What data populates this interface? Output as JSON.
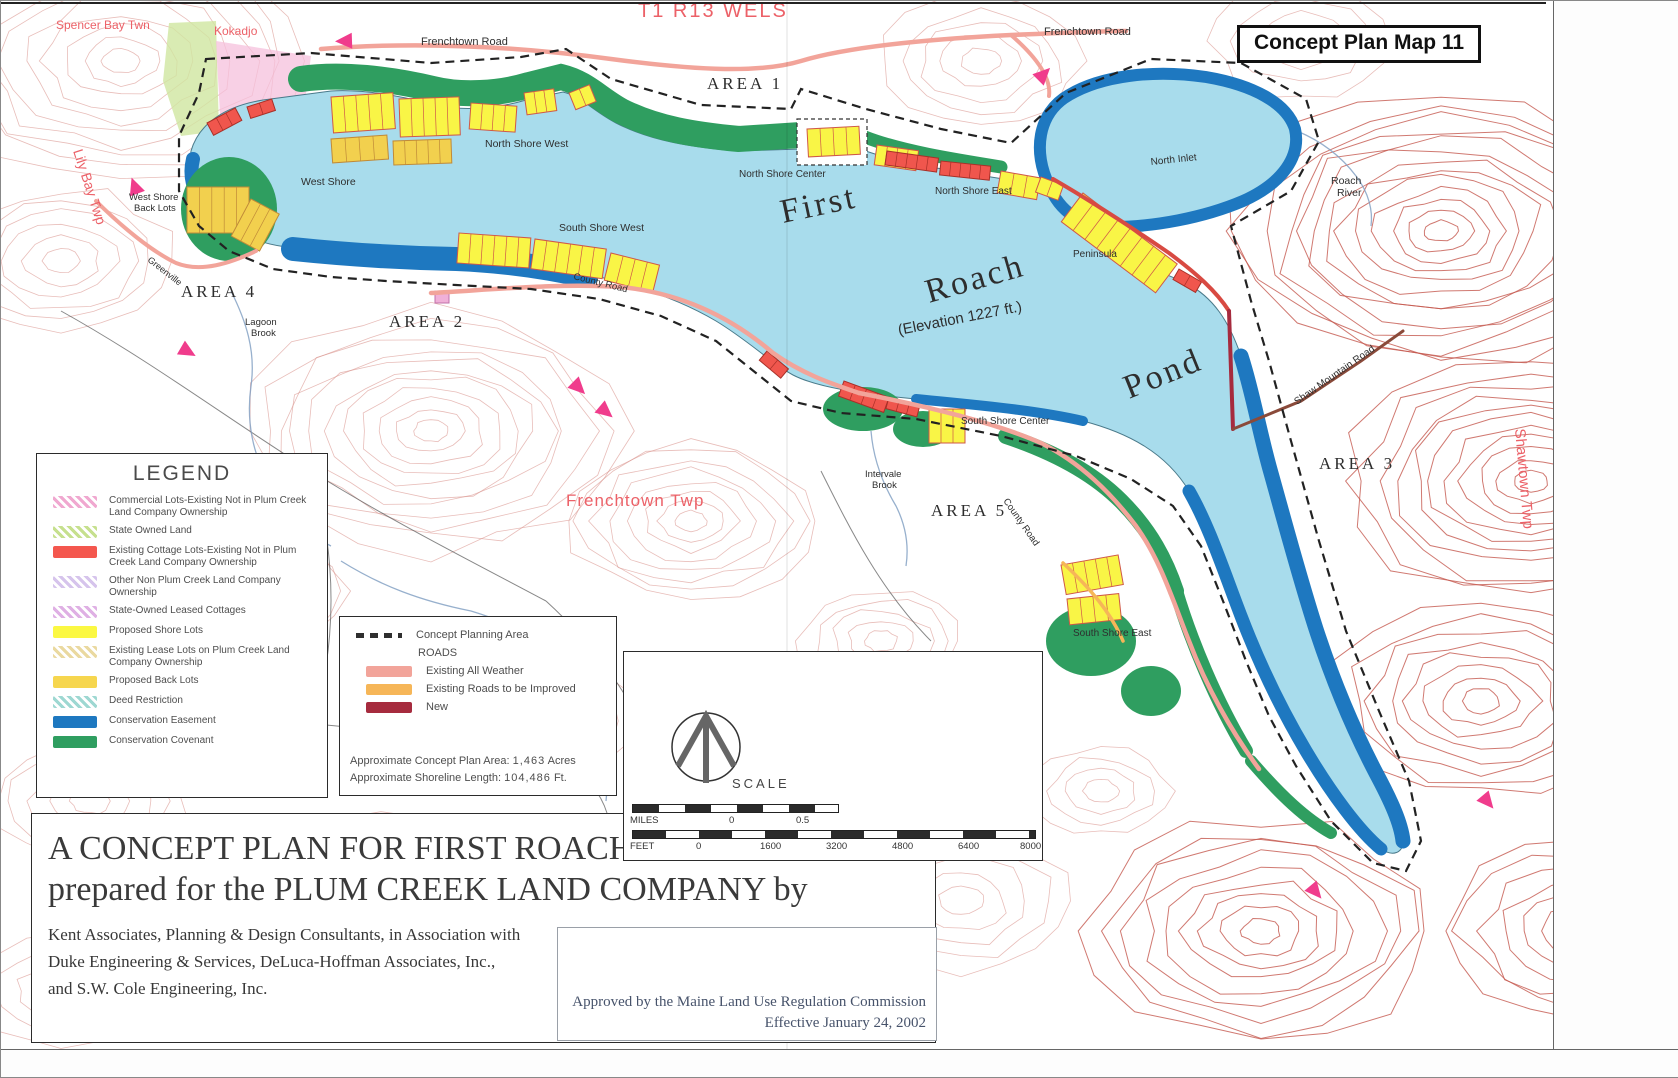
{
  "page": {
    "map_title": "Concept Plan Map 11"
  },
  "legend": {
    "title": "LEGEND",
    "items": [
      {
        "label": "Commercial Lots-Existing Not in Plum Creek Land Company Ownership",
        "color": "#f0a8d0",
        "style": "hatch"
      },
      {
        "label": "State Owned Land",
        "color": "#c6e08e",
        "style": "hatch"
      },
      {
        "label": "Existing Cottage Lots-Existing Not in Plum Creek Land Company Ownership",
        "color": "#f4574e",
        "style": "solid"
      },
      {
        "label": "Other Non Plum Creek Land Company Ownership",
        "color": "#d6c4ec",
        "style": "hatch"
      },
      {
        "label": "State-Owned Leased Cottages",
        "color": "#dfb0e4",
        "style": "hatch"
      },
      {
        "label": "Proposed Shore Lots",
        "color": "#fbf842",
        "style": "solid"
      },
      {
        "label": "Existing Lease Lots on Plum Creek Land Company Ownership",
        "color": "#ead9a0",
        "style": "hatch"
      },
      {
        "label": "Proposed Back Lots",
        "color": "#f6d64e",
        "style": "solid"
      },
      {
        "label": "Deed Restriction",
        "color": "#9ed8d2",
        "style": "hatch"
      },
      {
        "label": "Conservation Easement",
        "color": "#1e78c0",
        "style": "solid"
      },
      {
        "label": "Conservation Covenant",
        "color": "#2f9e60",
        "style": "solid"
      }
    ]
  },
  "plan_legend": {
    "planning_area": "Concept Planning Area",
    "roads_title": "ROADS",
    "roads": [
      {
        "label": "Existing All Weather",
        "color": "#f2a49a"
      },
      {
        "label": "Existing Roads to be Improved",
        "color": "#f6b658"
      },
      {
        "label": "New",
        "color": "#a62b3e"
      }
    ],
    "area_label": "Approximate Concept Plan Area:",
    "area_value": "1,463",
    "area_unit": "Acres",
    "shoreline_label": "Approximate Shoreline Length:",
    "shoreline_value": "104,486",
    "shoreline_unit": "Ft."
  },
  "scale": {
    "title": "SCALE",
    "miles": {
      "label": "MILES",
      "ticks": [
        "0",
        "0.5"
      ]
    },
    "feet": {
      "label": "FEET",
      "ticks": [
        "0",
        "1600",
        "3200",
        "4800",
        "6400",
        "8000"
      ]
    }
  },
  "title_block": {
    "line1": "A CONCEPT PLAN FOR FIRST ROACH POND",
    "line2": "prepared for the PLUM CREEK LAND COMPANY by",
    "credits": [
      "Kent Associates, Planning & Design Consultants, in Association with",
      "Duke Engineering & Services, DeLuca-Hoffman Associates, Inc.,",
      "and S.W. Cole Engineering, Inc."
    ],
    "approval": [
      "Approved by the Maine Land Use Regulation Commission",
      "Effective January 24, 2002"
    ]
  },
  "map_labels": [
    {
      "t": "Spencer Bay Twn",
      "x": 55,
      "y": 28,
      "s": 12,
      "c": "r"
    },
    {
      "t": "Kokadjo",
      "x": 213,
      "y": 34,
      "s": 12,
      "c": "r"
    },
    {
      "t": "T1 R13 WELS",
      "x": 637,
      "y": 16,
      "s": 20,
      "c": "r",
      "ls": 2
    },
    {
      "t": "Frenchtown Road",
      "x": 420,
      "y": 44,
      "s": 11,
      "c": "k"
    },
    {
      "t": "Frenchtown Road",
      "x": 1043,
      "y": 34,
      "s": 11,
      "c": "k"
    },
    {
      "t": "AREA 1",
      "x": 706,
      "y": 88,
      "s": 17,
      "c": "k",
      "f": "serif",
      "ls": 3
    },
    {
      "t": "Lily Bay Twp",
      "x": 72,
      "y": 150,
      "s": 14,
      "c": "r",
      "rot": 72
    },
    {
      "t": "West Shore",
      "x": 128,
      "y": 199,
      "s": 9.5,
      "c": "k"
    },
    {
      "t": "Back Lots",
      "x": 133,
      "y": 210,
      "s": 9.5,
      "c": "k"
    },
    {
      "t": "West Shore",
      "x": 300,
      "y": 184,
      "s": 10.5,
      "c": "k"
    },
    {
      "t": "North Shore West",
      "x": 484,
      "y": 146,
      "s": 10.5,
      "c": "k"
    },
    {
      "t": "North Shore Center",
      "x": 738,
      "y": 176,
      "s": 10,
      "c": "k"
    },
    {
      "t": "North Shore East",
      "x": 934,
      "y": 193,
      "s": 10,
      "c": "k"
    },
    {
      "t": "North Inlet",
      "x": 1150,
      "y": 164,
      "s": 10,
      "c": "k",
      "rot": -6
    },
    {
      "t": "Roach",
      "x": 1330,
      "y": 183,
      "s": 10.5,
      "c": "k"
    },
    {
      "t": "River",
      "x": 1336,
      "y": 195,
      "s": 10.5,
      "c": "k"
    },
    {
      "t": "First",
      "x": 782,
      "y": 222,
      "s": 34,
      "c": "k",
      "f": "serif",
      "rot": -12,
      "ls": 3
    },
    {
      "t": "Roach",
      "x": 928,
      "y": 302,
      "s": 34,
      "c": "k",
      "f": "serif",
      "rot": -16,
      "ls": 3
    },
    {
      "t": "Pond",
      "x": 1128,
      "y": 398,
      "s": 34,
      "c": "k",
      "f": "serif",
      "rot": -22,
      "ls": 3
    },
    {
      "t": "(Elevation 1227 ft.)",
      "x": 898,
      "y": 334,
      "s": 15,
      "c": "k",
      "rot": -11
    },
    {
      "t": "Peninsula",
      "x": 1072,
      "y": 256,
      "s": 10,
      "c": "k"
    },
    {
      "t": "South Shore West",
      "x": 558,
      "y": 230,
      "s": 10.5,
      "c": "k"
    },
    {
      "t": "County Road",
      "x": 572,
      "y": 278,
      "s": 9.5,
      "c": "k",
      "rot": 14
    },
    {
      "t": "Greenville",
      "x": 146,
      "y": 260,
      "s": 9,
      "c": "k",
      "rot": 38
    },
    {
      "t": "AREA 4",
      "x": 180,
      "y": 296,
      "s": 17,
      "c": "k",
      "f": "serif",
      "ls": 3
    },
    {
      "t": "Lagoon",
      "x": 244,
      "y": 324,
      "s": 9.5,
      "c": "k"
    },
    {
      "t": "Brook",
      "x": 250,
      "y": 335,
      "s": 9.5,
      "c": "k"
    },
    {
      "t": "AREA 2",
      "x": 388,
      "y": 326,
      "s": 17,
      "c": "k",
      "f": "serif",
      "ls": 3
    },
    {
      "t": "Frenchtown Twp",
      "x": 565,
      "y": 505,
      "s": 17,
      "c": "r",
      "ls": 1
    },
    {
      "t": "Intervale",
      "x": 864,
      "y": 476,
      "s": 9.5,
      "c": "k"
    },
    {
      "t": "Brook",
      "x": 871,
      "y": 487,
      "s": 9.5,
      "c": "k"
    },
    {
      "t": "AREA 5",
      "x": 930,
      "y": 515,
      "s": 17,
      "c": "k",
      "f": "serif",
      "ls": 3
    },
    {
      "t": "County Road",
      "x": 1002,
      "y": 500,
      "s": 9.5,
      "c": "k",
      "rot": 55
    },
    {
      "t": "South Shore Center",
      "x": 960,
      "y": 423,
      "s": 10,
      "c": "k"
    },
    {
      "t": "South Shore East",
      "x": 1072,
      "y": 635,
      "s": 10,
      "c": "k"
    },
    {
      "t": "Shaw Mountain Road",
      "x": 1296,
      "y": 404,
      "s": 10,
      "c": "k",
      "rot": -35
    },
    {
      "t": "AREA 3",
      "x": 1318,
      "y": 468,
      "s": 17,
      "c": "k",
      "f": "serif",
      "ls": 3
    },
    {
      "t": "Shawtown Twp",
      "x": 1514,
      "y": 428,
      "s": 15,
      "c": "r",
      "rot": 85
    }
  ],
  "colors": {
    "water": "#a8dcec",
    "conservation_easement": "#1e78c0",
    "conservation_covenant": "#2f9e60",
    "proposed_shore_lots": "#f9f546",
    "road_existing_all_weather": "#f2a49a",
    "road_new": "#a62b3e",
    "direction_arrow": "#f03c8c",
    "township_label_red": "#ec6168",
    "contour_line": "#d9918a"
  }
}
